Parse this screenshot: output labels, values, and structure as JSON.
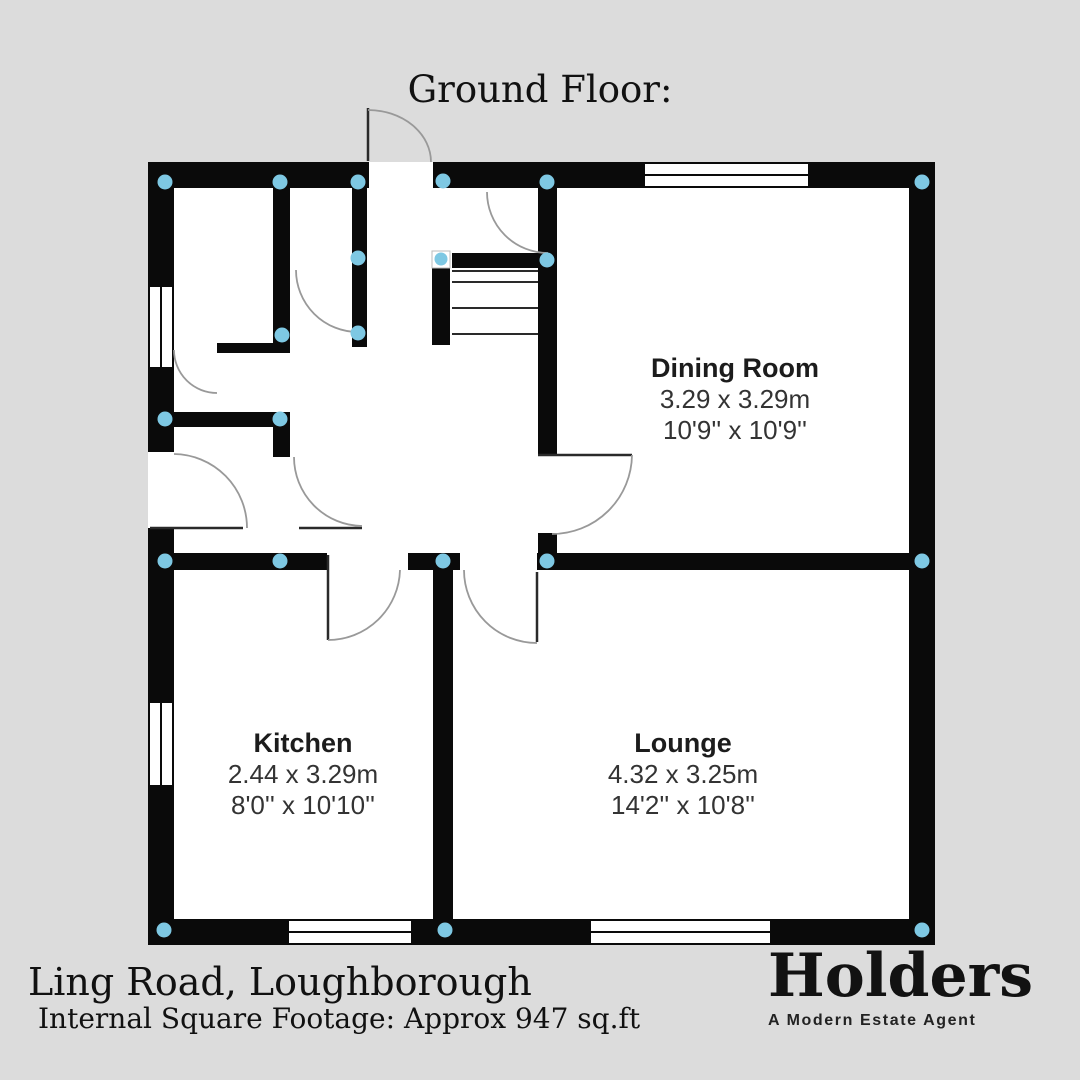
{
  "title": "Ground Floor:",
  "rooms": [
    {
      "name": "Dining Room",
      "metric": "3.29 x 3.29m",
      "imperial": "10'9'' x 10'9''"
    },
    {
      "name": "Kitchen",
      "metric": "2.44 x 3.29m",
      "imperial": "8'0'' x 10'10''"
    },
    {
      "name": "Lounge",
      "metric": "4.32 x 3.25m",
      "imperial": "14'2'' x 10'8''"
    }
  ],
  "footer": {
    "address": "Ling Road, Loughborough",
    "square_footage": "Internal Square Footage: Approx 947 sq.ft"
  },
  "brand": {
    "name": "Holders",
    "tagline": "A Modern Estate Agent"
  },
  "colors": {
    "background": "#dcdcdc",
    "wall": "#0a0a0a",
    "floor": "#ffffff",
    "junction_dot": "#7ec8e3",
    "door_arc": "#999999",
    "thin_line": "#2a2a2a"
  }
}
